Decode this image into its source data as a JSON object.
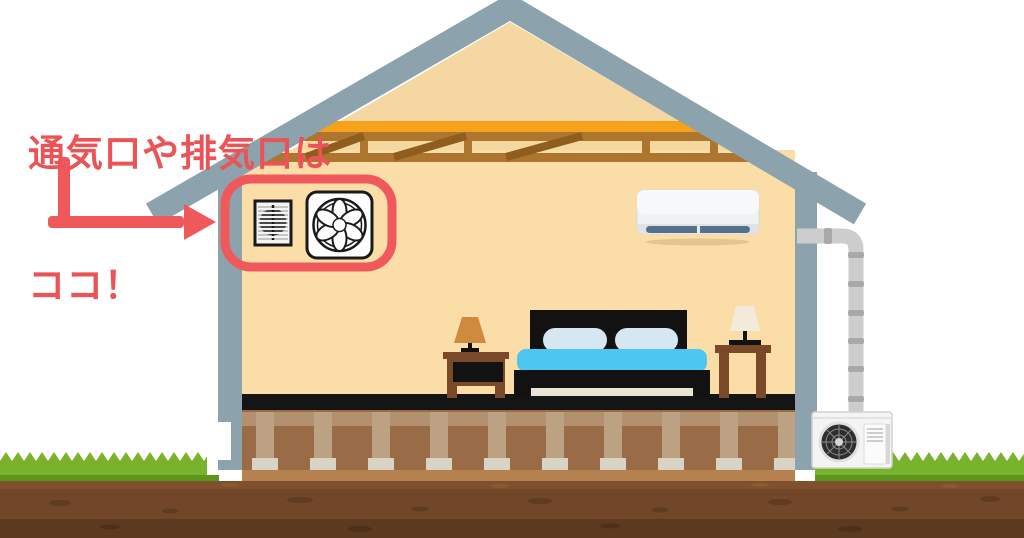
{
  "annotation": {
    "line1": "通気口や排気口は",
    "line2": "ココ！",
    "color": "#EA5456"
  },
  "scene": {
    "description": "Cross-section illustration of a house bedroom showing where ventilation and exhaust openings are located",
    "icons": [
      "vent-grille-icon",
      "exhaust-fan-icon",
      "indoor-air-conditioner",
      "outdoor-ac-unit",
      "arrow-icon"
    ]
  },
  "colors": {
    "accent": "#F0595C",
    "roof_gray": "#8CA2AC",
    "gable_peach": "#F5D7A2",
    "wall_peach": "#FBDDA8",
    "beam_orange": "#F5A11A",
    "truss_brown": "#AD752E",
    "truss_dark": "#8F5D1E",
    "floor_black": "#151515",
    "foundation_brown": "#9A6B47",
    "post_tan": "#BDA183",
    "footing_gray": "#D9D3C6",
    "soil_brown": "#714629",
    "grass_green": "#79B22C",
    "blanket_blue": "#4DC7F1",
    "pillow_blue": "#D7E7F2",
    "wood_brown": "#7A4A28",
    "lamp_orange": "#CE8B3D",
    "lamp_cream": "#F2EBDB",
    "ac_vent_blue": "#56708A",
    "pipe_gray": "#CDCDCD"
  }
}
